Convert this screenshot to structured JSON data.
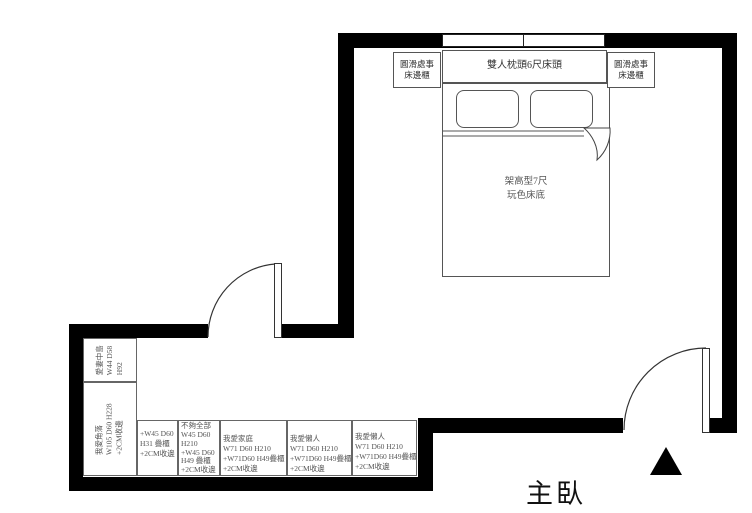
{
  "room": {
    "name": "主臥"
  },
  "bed": {
    "headboard_label": "雙人枕頭6尺床頭",
    "base_lines": [
      "架高型7尺",
      "玩色床底"
    ]
  },
  "nightstand": {
    "lines": [
      "圓滑處事",
      "床邊櫃"
    ]
  },
  "cabinets": {
    "island": {
      "lines": [
        "愛妻中島",
        "W44 D58",
        "H92"
      ]
    },
    "corner": {
      "lines": [
        "我愛角落",
        "W105 D60 H228",
        "+2CM收邊"
      ]
    },
    "row": [
      {
        "lines": [
          "+W45 D60",
          "H31 疊櫃",
          "+2CM收邊"
        ]
      },
      {
        "lines": [
          "不夠全部",
          "W45 D60",
          "H210",
          "+W45 D60",
          "H49 疊櫃",
          "+2CM收邊"
        ]
      },
      {
        "lines": [
          "我愛家庭",
          "W71 D60 H210",
          "+W71D60 H49疊櫃",
          "+2CM收邊"
        ]
      },
      {
        "lines": [
          "我愛懶人",
          "W71 D60 H210",
          "+W71D60 H49疊櫃",
          "+2CM收邊"
        ]
      },
      {
        "lines": [
          "我愛懶人",
          "W71 D60 H210",
          "+W71D60 H49疊櫃",
          "+2CM收邊"
        ]
      }
    ]
  },
  "colors": {
    "wall": "#000000",
    "furniture_line": "#555555",
    "text": "#333333"
  }
}
